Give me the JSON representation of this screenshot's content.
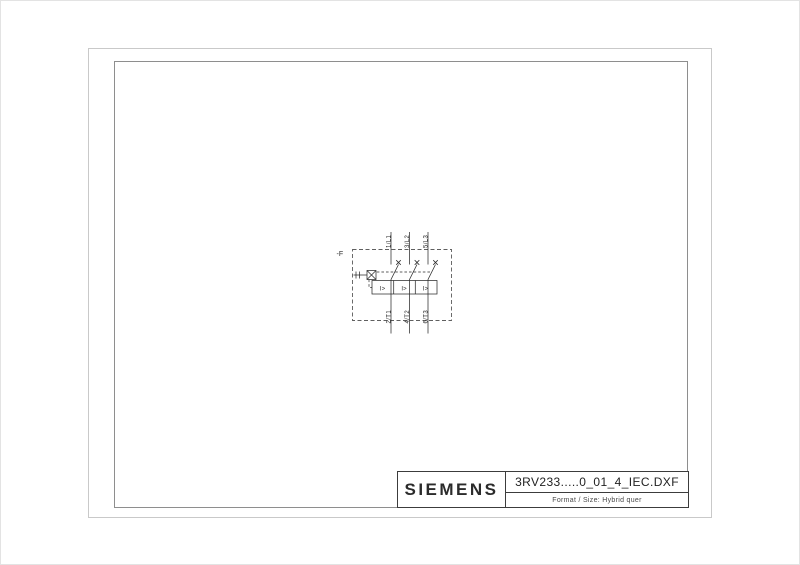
{
  "title_block": {
    "brand": "SIEMENS",
    "filename": "3RV233.....0_01_4_IEC.DXF",
    "format_label": "Format / Size: Hybrid quer"
  },
  "schematic": {
    "device_tag": "-F",
    "poles": [
      {
        "top_label": "1/L1",
        "bottom_label": "2/T1",
        "trip_symbol": "I>"
      },
      {
        "top_label": "3/L2",
        "bottom_label": "4/T2",
        "trip_symbol": "I>"
      },
      {
        "top_label": "5/L3",
        "bottom_label": "6/T3",
        "trip_symbol": "I>"
      }
    ]
  },
  "colors": {
    "line": "#2b2b2b",
    "frame_outer": "#c9c9c9",
    "frame_inner": "#8e8e8e",
    "title_block_border": "#3c3c3c"
  }
}
